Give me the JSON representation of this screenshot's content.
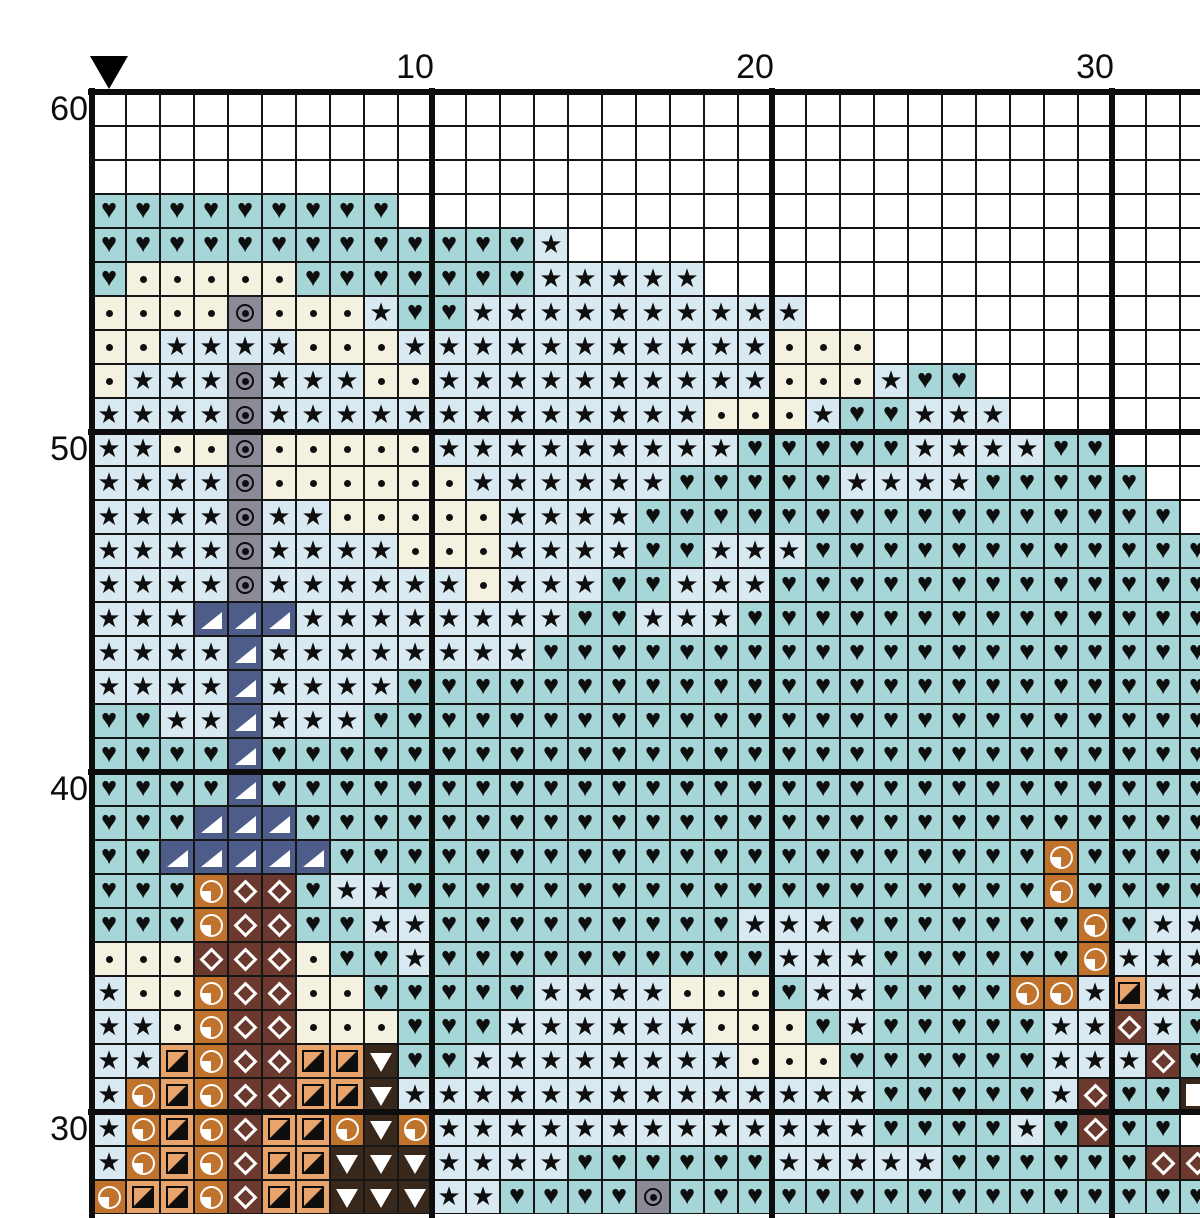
{
  "meta": {
    "description": "Cross-stitch pattern chart, partial view of top-left area of a counted-stitch design",
    "cell_size_px": 34,
    "grid_origin_px": {
      "x": 92,
      "y": 92
    },
    "major_gridline_every": 10,
    "visible_columns": 33,
    "visible_rows": 33
  },
  "axis": {
    "top_labels": [
      {
        "text": "10",
        "col": 10
      },
      {
        "text": "20",
        "col": 20
      },
      {
        "text": "30",
        "col": 30
      }
    ],
    "left_labels": [
      {
        "text": "60",
        "row_index": 0
      },
      {
        "text": "50",
        "row_index": 10
      },
      {
        "text": "40",
        "row_index": 20
      },
      {
        "text": "30",
        "row_index": 30
      }
    ]
  },
  "marker": {
    "col": 1,
    "shape": "down-triangle",
    "color": "#000000"
  },
  "grid": {
    "palette": {
      "white": "#ffffff",
      "teal": "#a6d6d8",
      "lightblue": "#d9e9f2",
      "cream": "#f4f1e1",
      "gray": "#8b8b98",
      "navy": "#4d5c88",
      "orange": "#c0732d",
      "tan": "#e9a46c",
      "brown": "#6b392e",
      "darkbrown": "#38271b"
    },
    "legend": {
      ".": {
        "bg": "white",
        "symbol": "none",
        "label": "empty"
      },
      "h": {
        "bg": "teal",
        "symbol": "heart",
        "label": "black heart on teal"
      },
      "s": {
        "bg": "lightblue",
        "symbol": "star",
        "label": "black star on light blue"
      },
      "d": {
        "bg": "cream",
        "symbol": "dot",
        "label": "black dot on cream"
      },
      "t": {
        "bg": "gray",
        "symbol": "target",
        "label": "circled dot on gray"
      },
      "n": {
        "bg": "navy",
        "symbol": "tri-corner",
        "label": "white corner triangle on navy"
      },
      "o": {
        "bg": "orange",
        "symbol": "quarter",
        "label": "white quarter-circle on orange"
      },
      "b": {
        "bg": "brown",
        "symbol": "diamond",
        "label": "white open diamond on brown"
      },
      "a": {
        "bg": "tan",
        "symbol": "half",
        "label": "half-filled square on tan"
      },
      "v": {
        "bg": "darkbrown",
        "symbol": "tri-down",
        "label": "white down triangle on dark brown"
      },
      "q": {
        "bg": "darkbrown",
        "symbol": "square",
        "label": "white square on dark brown"
      }
    },
    "first_row_number": 60,
    "rows": [
      ".................................",
      ".................................",
      ".................................",
      "hhhhhhhhh........................",
      "hhhhhhhhhhhhhs...................",
      "hdddddhhhhhhhsssss...............",
      "ddddtdddshhssssssssss............",
      "ddssssdddsssssssssssddd..........",
      "dssstsssddssssssssssdddshh.......",
      "sssstsssssssssssssdddshhsss......",
      "ssddtdddddssssssssshhhhhsssshh...",
      "sssstddddddsssssshhhhhsssshhhhh..",
      "sssstssdddddsssshhhhhhhhhhhhhhhh.",
      "sssstssssdddsssshhssshhhhhhhhhhhh",
      "sssstssssssdssshhssshhhhhhhhhhhhh",
      "sssnnnsssssssshhssshhhhhhhhhhhhhh",
      "ssssnsssssssshhhhhhhhhhhhhhhhhhhh",
      "ssssnsssshhhhhhhhhhhhhhhhhhhhhhhh",
      "hhssnssshhhhhhhhhhhhhhhhhhhhhhhhh",
      "hhhhnhhhhhhhhhhhhhhhhhhhhhhhhhhhh",
      "hhhhnhhhhhhhhhhhhhhhhhhhhhhhhhhhh",
      "hhhnnnhhhhhhhhhhhhhhhhhhhhhhhhhhh",
      "hhnnnnnhhhhhhhhhhhhhhhhhhhhhohhhh",
      "hhhobbhsshhhhhhhhhhhhhhhhhhhohhhh",
      "hhhobbhhsshhhhhhhhhssshhhhhhhohss",
      "dddbbbdhhshhhhhhhhhhssshhhhhhosss",
      "sddobbddhhhhhssssdddhsshhhhoosass",
      "ssdobbdddhhhssssssdddhshhhhhssbsh",
      "ssaobbaavhhssssssssdddhhhhhhsssbh",
      "soaobbaavsssssssssssssshhhhhsbhhq",
      "soaobaaovossssssssssssshhhhshbhh",
      "soaobaavvvsssshhhhhhssssshhhhhhbb",
      "oaaobaavvvsshhhhthhhhhhhhhhhhhhhh"
    ]
  }
}
